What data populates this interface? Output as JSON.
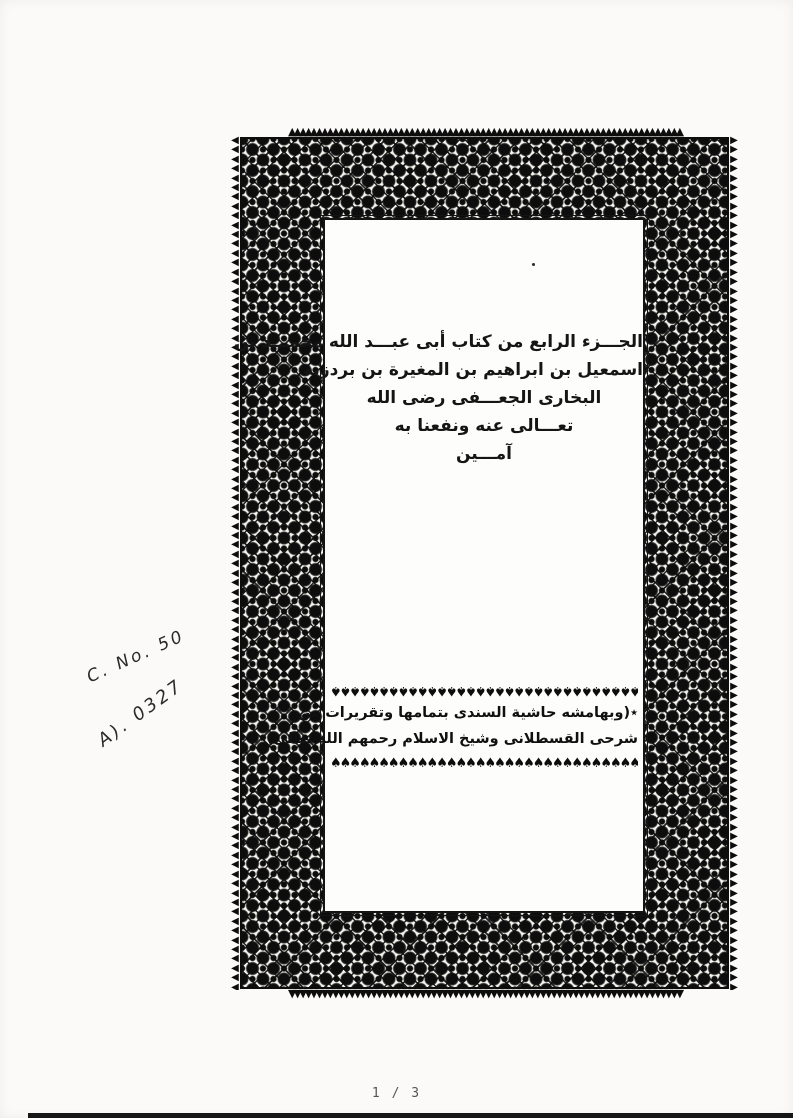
{
  "viewer": {
    "page_indicator": "1 / 3"
  },
  "scan": {
    "title_lines": [
      "الجـــزء الرابع من كتاب أبى عبـــد الله محمـــد بن",
      "اسمعيل بن ابراهيم بن المغيرة بن بردزبه",
      "البخارى الجعـــفى رضى الله",
      "تعـــالى عنه ونفعنا به",
      "آمـــين"
    ],
    "margin_note_lines": [
      "٭(وبهامشه حاشية السندى بتمامها وتقريرات من",
      "شرحى القسطلانى وشيخ الاسلام رحمهم الله تعالى)٭"
    ],
    "handwritten_note_1": "C. No. 50",
    "handwritten_note_2": "A). 0327"
  },
  "glyphs": {
    "tooth_up": "▲",
    "tooth_down": "▼",
    "tooth_left": "◀",
    "tooth_right": "▶",
    "fleuron": "♠"
  },
  "colors": {
    "ink": "#0d0d0d",
    "paper": "#fbfaf8",
    "panel_paper": "#fdfdfb",
    "page_indicator_text": "#555555",
    "bottom_bar": "#161616"
  }
}
